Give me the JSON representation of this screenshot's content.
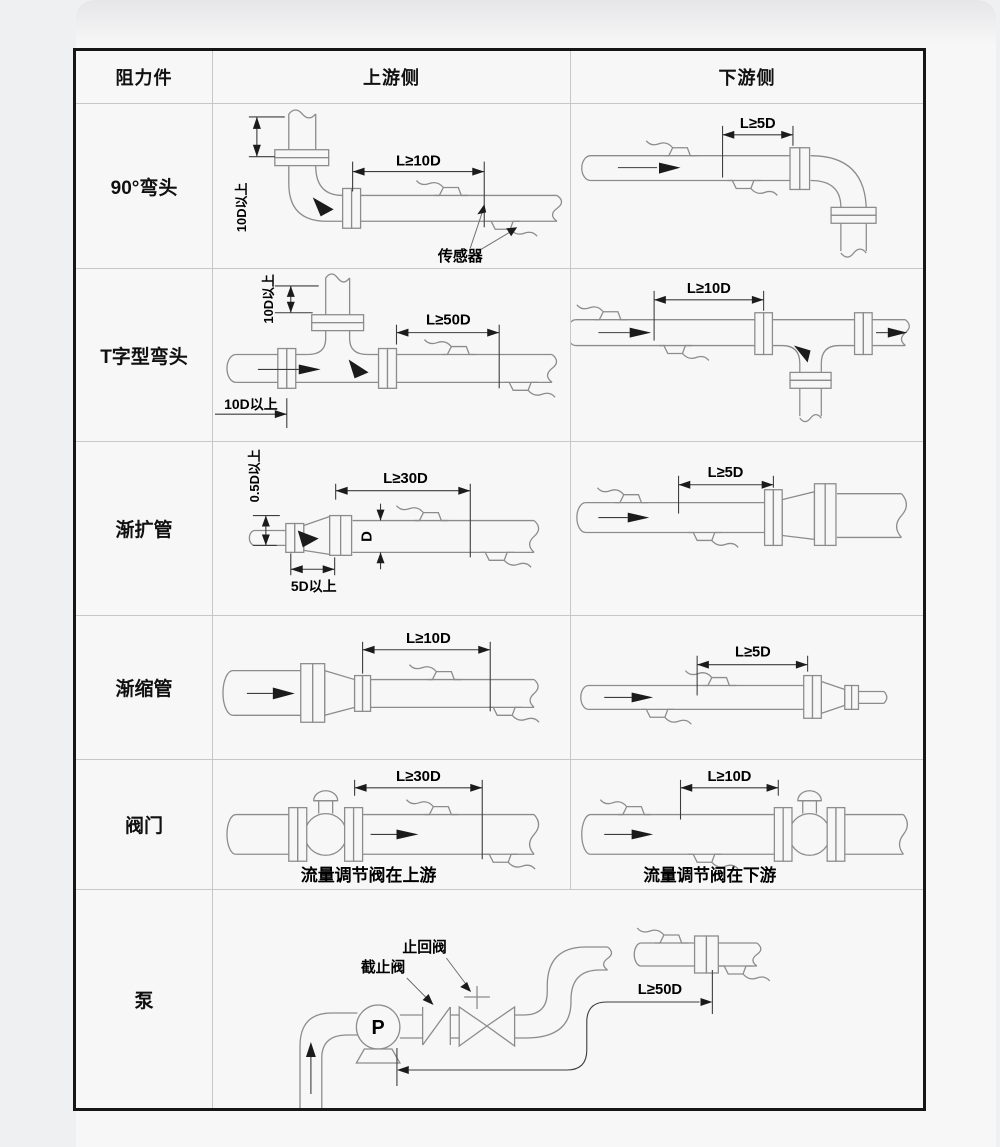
{
  "colors": {
    "page_bg": "#eff0f1",
    "card_bg": "#f7f7f8",
    "outer_border": "#161616",
    "grid_line": "#c7c7c9",
    "pipe_line": "#8c8c8c",
    "dim_line": "#3c3c3c",
    "text": "#000000"
  },
  "table": {
    "headers": {
      "resistance": "阻力件",
      "upstream": "上游侧",
      "downstream": "下游侧"
    },
    "rows": [
      {
        "label": "90°弯头",
        "up": {
          "dim_main": "L≥10D",
          "dim_vert": "10D以上",
          "sensor_label": "传感器"
        },
        "down": {
          "dim_main": "L≥5D"
        }
      },
      {
        "label": "T字型弯头",
        "up": {
          "dim_main": "L≥50D",
          "dim_vert": "10D以上",
          "dim_left": "10D以上"
        },
        "down": {
          "dim_main": "L≥10D"
        }
      },
      {
        "label": "渐扩管",
        "up": {
          "dim_main": "L≥30D",
          "dim_vert": "0.5D以上",
          "dim_bottom": "5D以上",
          "dim_d": "D"
        },
        "down": {
          "dim_main": "L≥5D"
        }
      },
      {
        "label": "渐缩管",
        "up": {
          "dim_main": "L≥10D"
        },
        "down": {
          "dim_main": "L≥5D"
        }
      },
      {
        "label": "阀门",
        "up": {
          "dim_main": "L≥30D",
          "caption": "流量调节阀在上游"
        },
        "down": {
          "dim_main": "L≥10D",
          "caption": "流量调节阀在下游"
        }
      },
      {
        "label": "泵",
        "merged": {
          "pump_label": "P",
          "stop_valve_label": "截止阀",
          "check_valve_label": "止回阀",
          "dim_main": "L≥50D"
        }
      }
    ]
  }
}
